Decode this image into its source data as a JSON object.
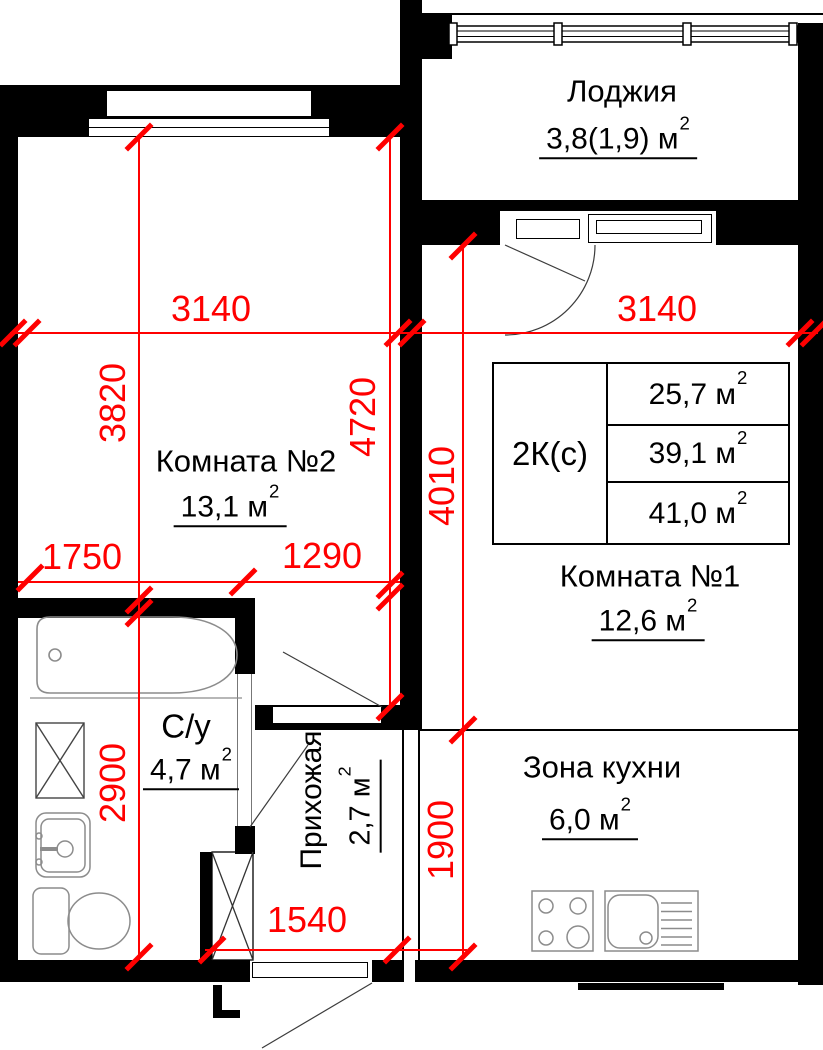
{
  "sup": "2",
  "colors": {
    "dimension": "#ff0000",
    "wall": "#000000",
    "fixture_outline": "#8c8c8c"
  },
  "rooms": {
    "loggia": {
      "name": "Лоджия",
      "area": "3,8(1,9) м"
    },
    "room2": {
      "name": "Комната №2",
      "area": "13,1 м"
    },
    "room1": {
      "name": "Комната №1",
      "area": "12,6 м"
    },
    "bathroom": {
      "name": "С/у",
      "area": "4,7 м"
    },
    "hallway": {
      "name": "Прихожая",
      "area": "2,7 м"
    },
    "kitchen": {
      "name": "Зона кухни",
      "area": "6,0 м"
    }
  },
  "info_table": {
    "type": "2К(с)",
    "areas": [
      "25,7 м",
      "39,1 м",
      "41,0 м"
    ]
  },
  "dims": {
    "room2_width": "3140",
    "room1_width": "3140",
    "room2_height": "3820",
    "left_total_height": "4720",
    "room1_height": "4010",
    "bath_height": "2900",
    "kitchen_height": "1900",
    "seg_a": "1750",
    "seg_b": "1290",
    "hall_width": "1540"
  }
}
